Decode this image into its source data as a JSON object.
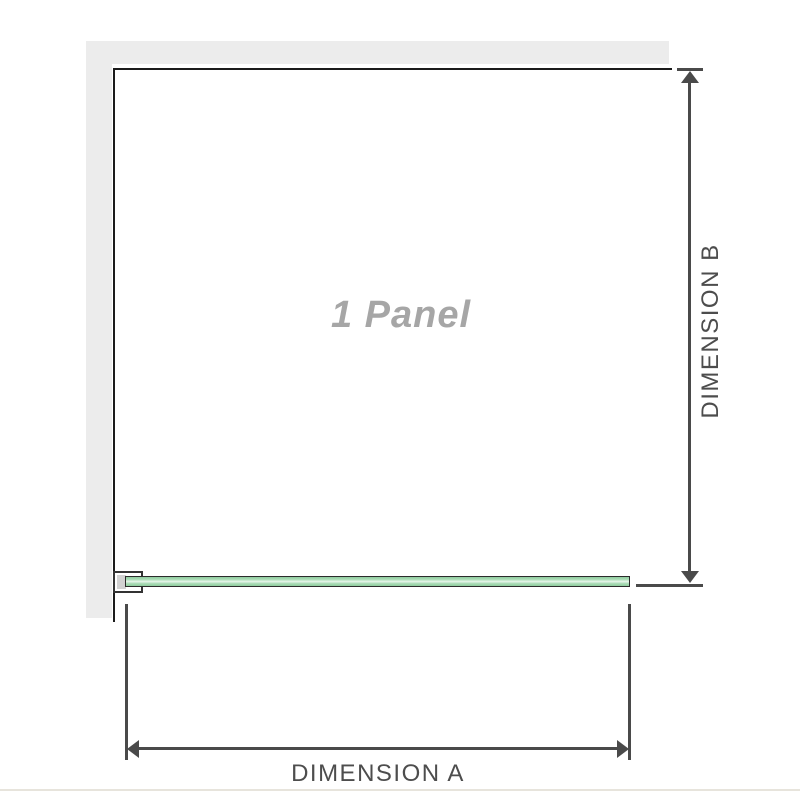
{
  "diagram": {
    "title": "1 Panel",
    "dimensions": {
      "a": {
        "label": "DIMENSION A",
        "orientation": "horizontal"
      },
      "b": {
        "label": "DIMENSION B",
        "orientation": "vertical"
      }
    },
    "colors": {
      "wall": "#ececec",
      "outline": "#1b1b1b",
      "dimension_line": "#4a4a4a",
      "dimension_label": "#4d4d4d",
      "panel_title": "#a6a6a6",
      "glass_green": "#9fd4ac",
      "glass_highlight": "#e9f6ec",
      "glass_border": "#2b2b2b",
      "bracket_fill": "#ffffff",
      "bracket_block": "#d2d2d2",
      "footer_divider": "#e7e4dc"
    }
  }
}
